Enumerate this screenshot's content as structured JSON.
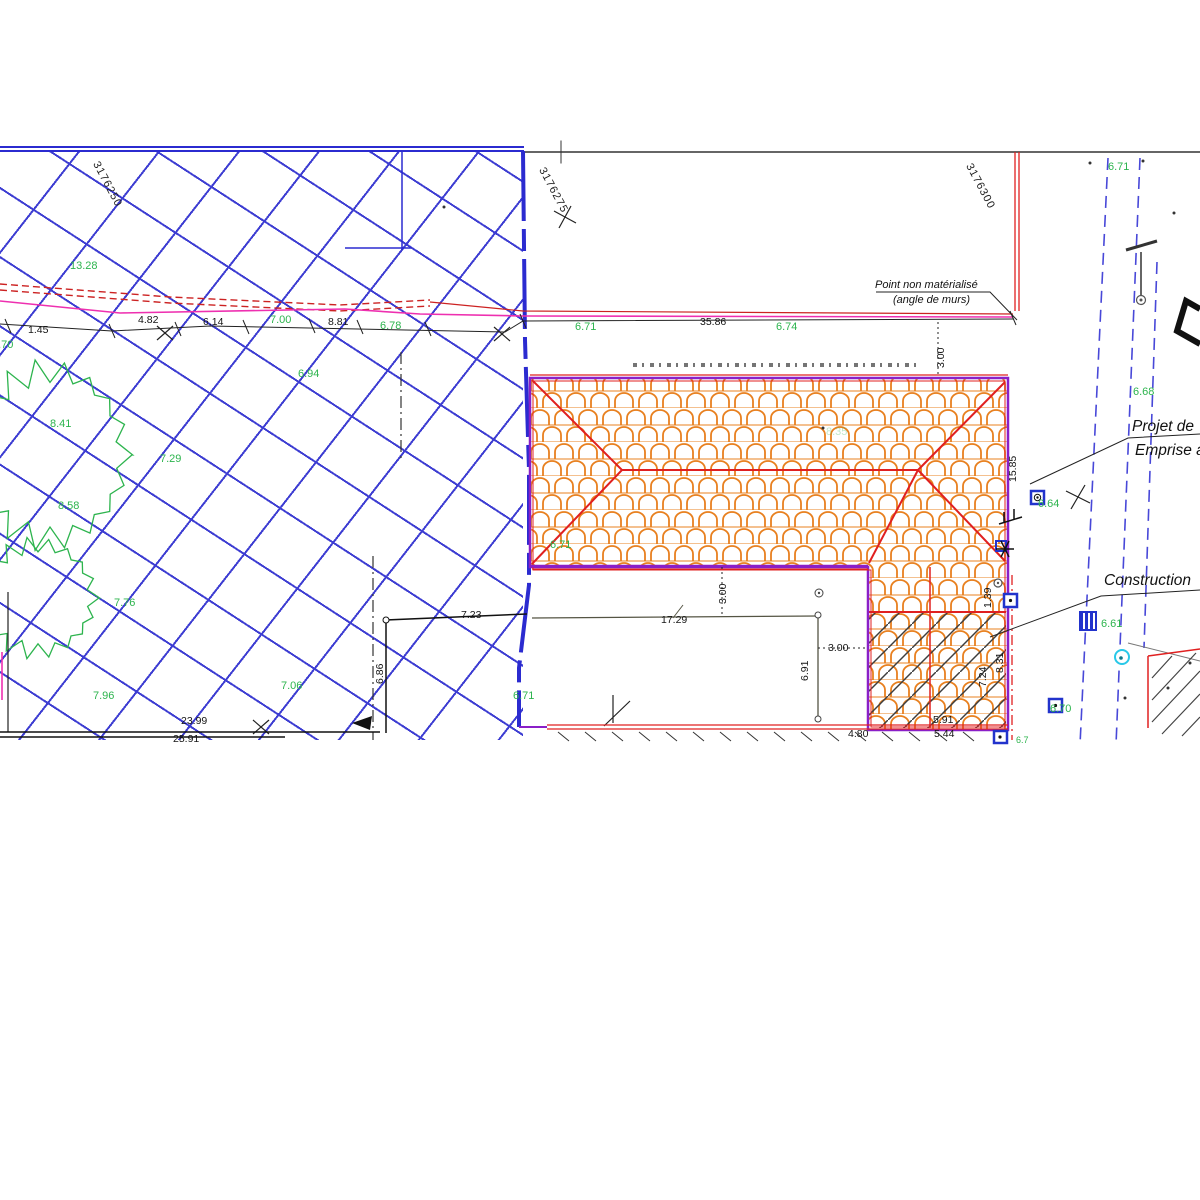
{
  "drawing": {
    "colors": {
      "hatch_blue": "#3d3dd2",
      "boundary_blue": "#2b2bd0",
      "parcel_purple": "#8a1fc8",
      "roof_tile_orange": "#e8801f",
      "ridge_red": "#e02020",
      "fence_magenta": "#ee30b0",
      "spot_green": "#2db44e",
      "cyan_icon": "#29c8e8"
    },
    "labels": [
      {
        "t": "3176250",
        "x": 100,
        "y": 160,
        "cls": "grid",
        "rot": 62
      },
      {
        "t": "3176275",
        "x": 546,
        "y": 166,
        "cls": "grid",
        "rot": 62
      },
      {
        "t": "3176300",
        "x": 973,
        "y": 162,
        "cls": "grid",
        "rot": 62
      },
      {
        "t": "13.28",
        "x": 70,
        "y": 261,
        "cls": "spot"
      },
      {
        "t": "6.70",
        "x": -8,
        "y": 340,
        "cls": "spot"
      },
      {
        "t": "8.41",
        "x": 50,
        "y": 419,
        "cls": "spot"
      },
      {
        "t": "7.29",
        "x": 160,
        "y": 454,
        "cls": "spot"
      },
      {
        "t": "8.58",
        "x": 58,
        "y": 501,
        "cls": "spot"
      },
      {
        "t": "6.94",
        "x": 298,
        "y": 369,
        "cls": "spot"
      },
      {
        "t": "7.00",
        "x": 270,
        "y": 315,
        "cls": "spot"
      },
      {
        "t": "6.78",
        "x": 380,
        "y": 321,
        "cls": "spot"
      },
      {
        "t": "6.71",
        "x": 575,
        "y": 322,
        "cls": "spot"
      },
      {
        "t": "6.74",
        "x": 776,
        "y": 322,
        "cls": "spot"
      },
      {
        "t": "7.76",
        "x": 114,
        "y": 598,
        "cls": "spot"
      },
      {
        "t": "7.96",
        "x": 93,
        "y": 691,
        "cls": "spot"
      },
      {
        "t": "7.06",
        "x": 281,
        "y": 681,
        "cls": "spot"
      },
      {
        "t": "6.71",
        "x": 513,
        "y": 691,
        "cls": "spot"
      },
      {
        "t": "6.71",
        "x": 550,
        "y": 540,
        "cls": "spot"
      },
      {
        "t": "8.35",
        "x": 826,
        "y": 427,
        "cls": "spot",
        "op": 0.3
      },
      {
        "t": "6.71",
        "x": 1108,
        "y": 162,
        "cls": "spot"
      },
      {
        "t": "6.68",
        "x": 1133,
        "y": 387,
        "cls": "spot"
      },
      {
        "t": "6.64",
        "x": 1038,
        "y": 499,
        "cls": "spot"
      },
      {
        "t": "6.61",
        "x": 1101,
        "y": 619,
        "cls": "spot"
      },
      {
        "t": "6.70",
        "x": 1050,
        "y": 704,
        "cls": "spot"
      },
      {
        "t": "6.7",
        "x": 1016,
        "y": 736,
        "cls": "spot",
        "size": 9
      },
      {
        "t": "1.45",
        "x": 28,
        "y": 325,
        "cls": "dim"
      },
      {
        "t": "4.82",
        "x": 138,
        "y": 315,
        "cls": "dim"
      },
      {
        "t": "6.14",
        "x": 203,
        "y": 317,
        "cls": "dim"
      },
      {
        "t": "8.81",
        "x": 328,
        "y": 317,
        "cls": "dim"
      },
      {
        "t": "35.86",
        "x": 700,
        "y": 317,
        "cls": "dim"
      },
      {
        "t": "3.00",
        "x": 936,
        "y": 368,
        "cls": "dim",
        "rot": -90
      },
      {
        "t": "15.85",
        "x": 1008,
        "y": 482,
        "cls": "dim",
        "rot": -90
      },
      {
        "t": "17.29",
        "x": 661,
        "y": 615,
        "cls": "dim"
      },
      {
        "t": "3.00",
        "x": 718,
        "y": 604,
        "cls": "dim",
        "rot": -90
      },
      {
        "t": "3.00",
        "x": 828,
        "y": 643,
        "cls": "dim"
      },
      {
        "t": "6.91",
        "x": 800,
        "y": 681,
        "cls": "dim",
        "rot": -90
      },
      {
        "t": "7.23",
        "x": 461,
        "y": 610,
        "cls": "dim"
      },
      {
        "t": "6.86",
        "x": 375,
        "y": 684,
        "cls": "dim",
        "rot": -90
      },
      {
        "t": "23.99",
        "x": 181,
        "y": 716,
        "cls": "dim"
      },
      {
        "t": "25.91",
        "x": 173,
        "y": 734,
        "cls": "dim"
      },
      {
        "t": "4.80",
        "x": 848,
        "y": 729,
        "cls": "dim"
      },
      {
        "t": "5.44",
        "x": 934,
        "y": 729,
        "cls": "dim"
      },
      {
        "t": "5.91",
        "x": 933,
        "y": 715,
        "cls": "dim"
      },
      {
        "t": "1.39",
        "x": 983,
        "y": 608,
        "cls": "dim",
        "rot": -90
      },
      {
        "t": "8.31",
        "x": 995,
        "y": 673,
        "cls": "dim",
        "rot": -90
      },
      {
        "t": "7.24",
        "x": 978,
        "y": 687,
        "cls": "dim",
        "rot": -90
      },
      {
        "t": "Point non matérialisé",
        "x": 875,
        "y": 280,
        "cls": "note"
      },
      {
        "t": "(angle de murs)",
        "x": 893,
        "y": 295,
        "cls": "note"
      },
      {
        "t": "Projet de ",
        "x": 1132,
        "y": 419,
        "cls": "big"
      },
      {
        "t": "Emprise a",
        "x": 1135,
        "y": 443,
        "cls": "big"
      },
      {
        "t": "Construction",
        "x": 1104,
        "y": 573,
        "cls": "big"
      }
    ]
  }
}
